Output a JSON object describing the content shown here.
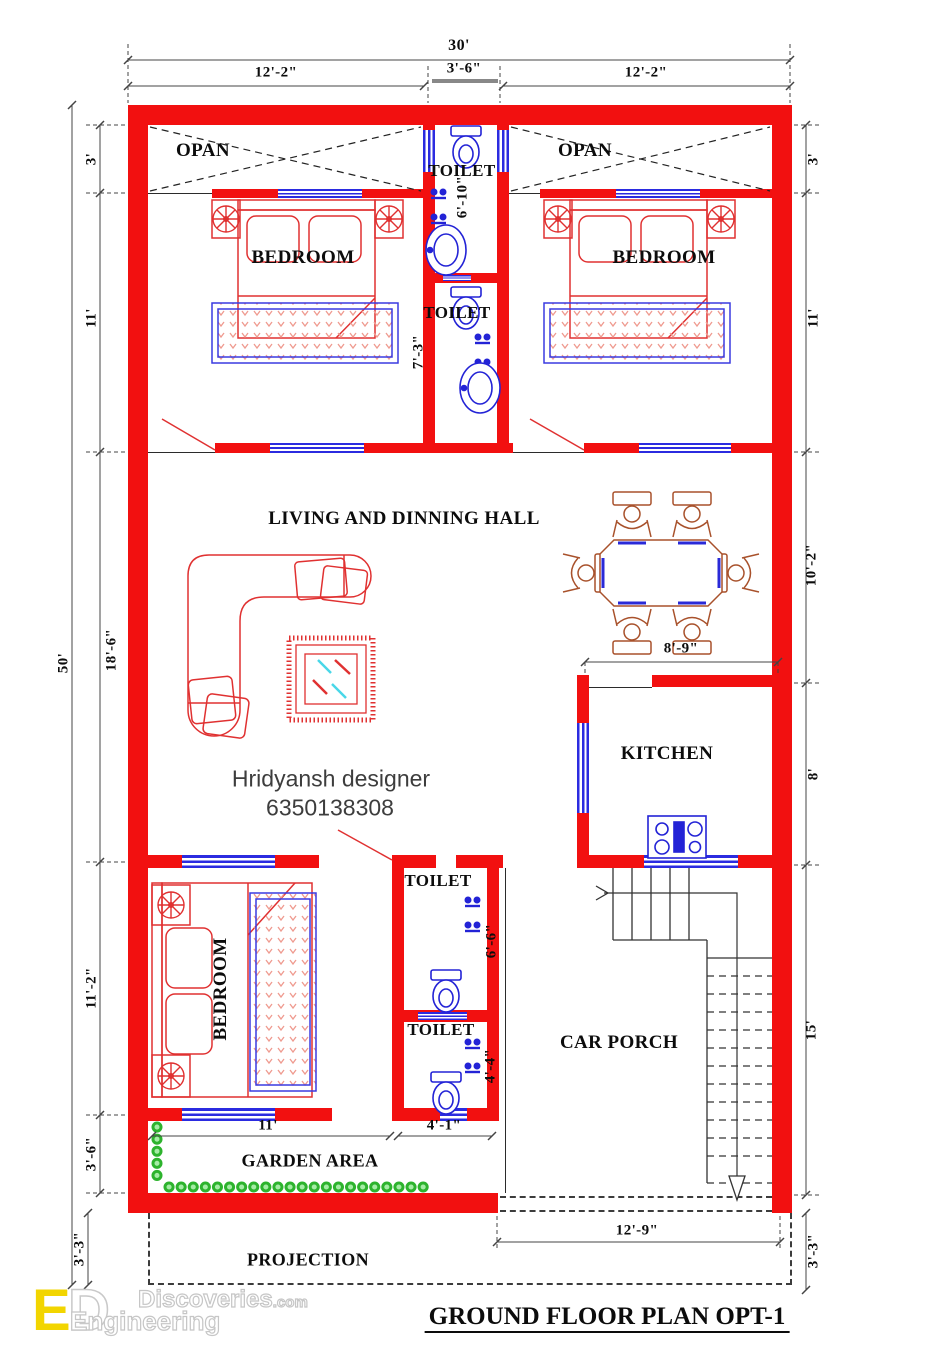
{
  "title": "GROUND FLOOR PLAN OPT-1",
  "designer": {
    "name": "Hridyansh designer",
    "phone": "6350138308"
  },
  "rooms": {
    "opan_left": "OPAN",
    "opan_right": "OPAN",
    "toilet_top": "TOILET",
    "toilet_mid": "TOILET",
    "bedroom_left": "BEDROOM",
    "bedroom_right": "BEDROOM",
    "living_hall": "LIVING AND DINNING HALL",
    "kitchen": "KITCHEN",
    "bedroom_bottom": "BEDROOM",
    "toilet_lower1": "TOILET",
    "toilet_lower2": "TOILET",
    "car_porch": "CAR PORCH",
    "garden": "GARDEN AREA",
    "projection": "PROJECTION"
  },
  "dims": {
    "top_total": "30'",
    "top_left": "12'-2\"",
    "top_mid": "3'-6\"",
    "top_right": "12'-2\"",
    "left_opan": "3'",
    "left_bedroom": "11'",
    "left_living": "18'-6\"",
    "left_total": "50'",
    "left_bedroom2": "11'-2\"",
    "left_garden": "3'-6\"",
    "left_projection": "3'-3\"",
    "right_opan": "3'",
    "right_bedroom": "11'",
    "right_dining": "10'-2\"",
    "right_kitchen": "8'",
    "right_porch": "15'",
    "right_projection": "3'-3\"",
    "toilet_top_len": "6'-10\"",
    "toilet_mid_len": "7'-3\"",
    "kitchen_width": "8'-9\"",
    "toilet_lower1_len": "6'-6\"",
    "toilet_lower2_len": "4'-4\"",
    "garden_left_width": "11'",
    "garden_right_width": "4'-1\"",
    "projection_width": "12'-9\""
  },
  "logo": {
    "letter_e": "E",
    "letter_d": "D",
    "word1": "Discoveries",
    "word1_suffix": ".com",
    "word2": "Engineering"
  },
  "colors": {
    "wall_red": "#f21010",
    "window_blue": "#2b2be0",
    "fixture_blue": "#2323d6",
    "furniture_red": "#e03131",
    "dining_brown": "#a8512b",
    "garden_green": "#2db32d",
    "glass_cyan": "#49d7e8",
    "logo_yellow": "#f2d500"
  }
}
